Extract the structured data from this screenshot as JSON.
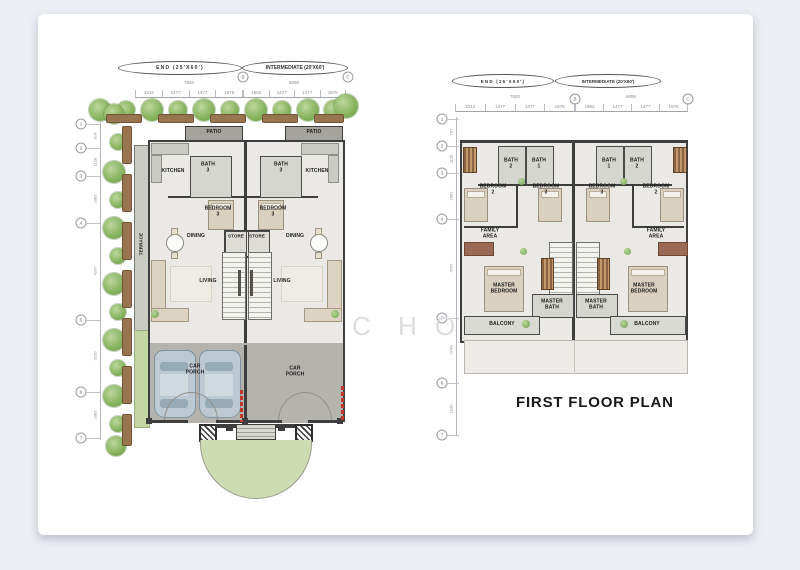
{
  "labels": {
    "end": "END (25'X60')",
    "intermediate": "INTERMEDIATE (20'X60')"
  },
  "ground_floor": {
    "top_dims": {
      "left_total": "7620",
      "right_total": "6096",
      "left_segments": [
        "1512",
        "1477",
        "1477",
        "1878"
      ],
      "right_segments": [
        "1562",
        "1477",
        "1477",
        "1575"
      ],
      "marker_b": "B",
      "marker_c": "C"
    },
    "left_dims": {
      "markers": [
        "1",
        "2",
        "3",
        "4",
        "5",
        "6",
        "7"
      ],
      "segments": [
        "914",
        "1128",
        "2082",
        "4267",
        "3150",
        "2082"
      ]
    },
    "rooms": {
      "patio": "PATIO",
      "kitchen": "KITCHEN",
      "bath3": "BATH\n3",
      "bedroom3": "BEDROOM\n3",
      "dining": "DINING",
      "store": "STORE",
      "living": "LIVING",
      "terrace": "TERRACE",
      "car_porch": "CAR\nPORCH"
    }
  },
  "first_floor": {
    "title": "FIRST FLOOR PLAN",
    "top_dims": {
      "left_total": "7620",
      "right_total": "6096",
      "left_segments": [
        "1512",
        "1477",
        "1477",
        "1878"
      ],
      "right_segments": [
        "1562",
        "1477",
        "1477",
        "1575"
      ],
      "marker_b": "B",
      "marker_c": "C"
    },
    "left_dims": {
      "markers": [
        "1",
        "2",
        "3",
        "4",
        "5",
        "6",
        "7"
      ],
      "segments": [
        "762",
        "1128",
        "2082",
        "4267",
        "2743",
        "1930"
      ]
    },
    "rooms": {
      "bath1": "BATH\n1",
      "bath2": "BATH\n2",
      "bedroom2": "BEDROOM\n2",
      "bedroom3": "BEDROOM\n3",
      "family_area": "FAMILY\nAREA",
      "master_bedroom": "MASTER\nBEDROOM",
      "master_bath": "MASTER\nBATH",
      "balcony": "BALCONY"
    }
  },
  "watermark": {
    "letters": [
      "C",
      "H",
      "O"
    ]
  },
  "colors": {
    "wall": "#3e3e3e",
    "gate_red": "#c0392b",
    "landscape_green": "#85b25c",
    "lawn": "#cddcb2"
  }
}
